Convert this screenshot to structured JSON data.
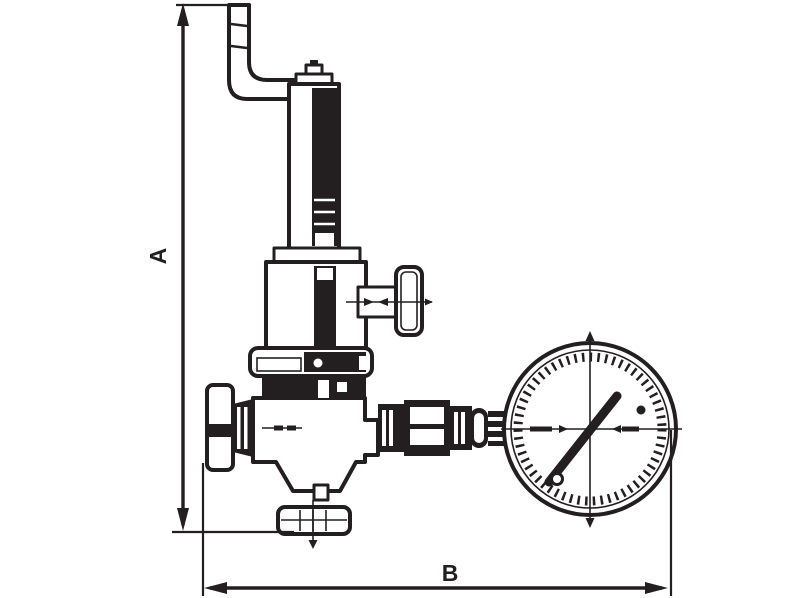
{
  "page": {
    "background": "#ffffff",
    "line_color": "#231f20"
  },
  "drawing": {
    "kind": "valve-with-gauge-dimensional-drawing",
    "dimensions": {
      "height_label": "A",
      "width_label": "B"
    }
  }
}
